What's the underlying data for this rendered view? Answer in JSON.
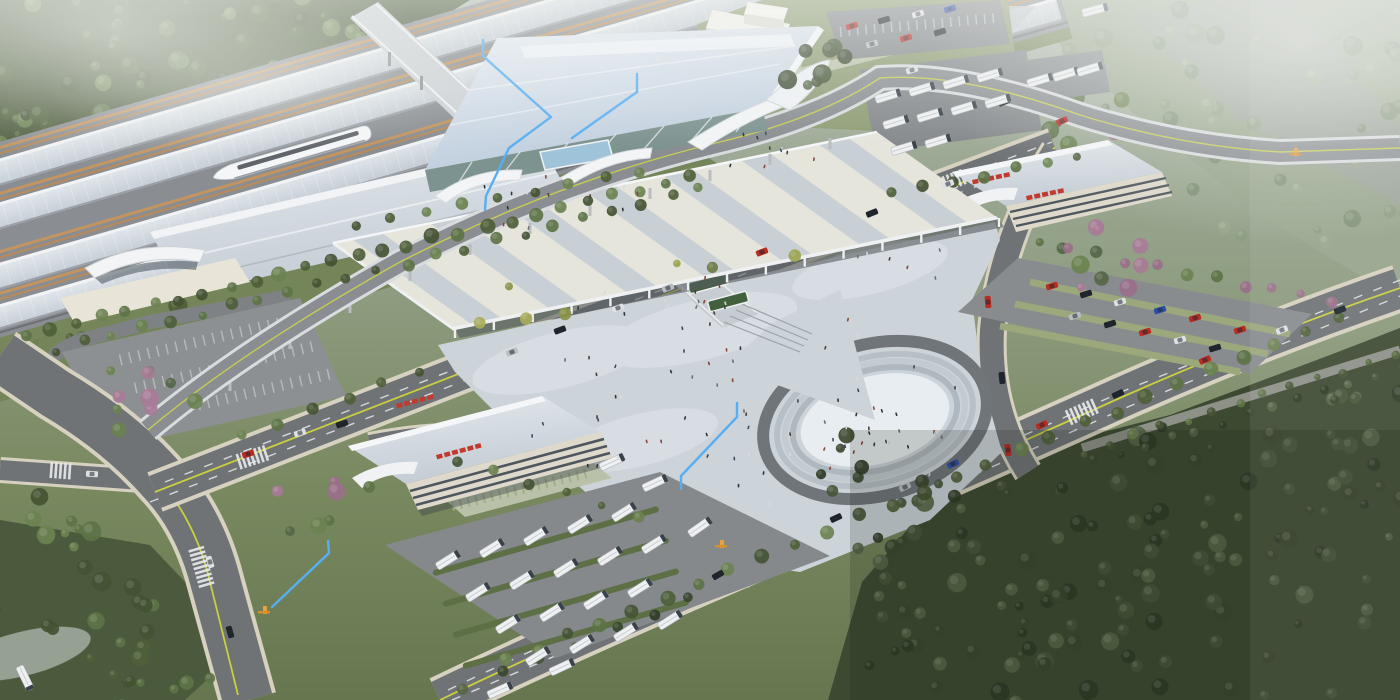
{
  "scene": {
    "kind": "aerial-architectural-rendering",
    "regions": [
      {
        "id": "railway-platforms",
        "label": "railway platforms and tracks with high-speed train"
      },
      {
        "id": "station-hall",
        "label": "main station terminal hall with glass facade"
      },
      {
        "id": "departure-canopy",
        "label": "large striped concourse canopy"
      },
      {
        "id": "central-plaza",
        "label": "pedestrian plaza with oval amphitheater"
      },
      {
        "id": "bus-terminal",
        "label": "bus terminal building and bus yard"
      },
      {
        "id": "parking-garage-east",
        "label": "east parking garage and car lot"
      },
      {
        "id": "roads",
        "label": "boulevards with lane markings and vehicles"
      },
      {
        "id": "forest",
        "label": "surrounding forest and misty terrain"
      }
    ],
    "signage": {
      "note": "illegible red character blocks on building roofs",
      "color": "#c23a2e"
    }
  },
  "palette": {
    "sky_mist": "#aeb8ab",
    "terrain_green": "#7a8a62",
    "forest_dark": "#3c4a30",
    "forest_mid": "#55663f",
    "tree_light": "#7d9258",
    "grass_verge": "#74855a",
    "lawn": "#8e9d74",
    "track_bed": "#8a8e92",
    "track_stripe": "#c3945f",
    "platform_canopy": "#ccd2d8",
    "station_roof": "#cfdcea",
    "glass_facade": "#7d9390",
    "entrance_white": "#f2f4f6",
    "big_canopy_base": "#e6e5dc",
    "big_canopy_stripe": "#c2ccd4",
    "canopy_shadow": "#565c61",
    "plaza_paving": "#ccd4da",
    "oval_inner": "#e8edf1",
    "step_ring": "#b8c0c7",
    "road_asphalt": "#6f7376",
    "road_ramp": "#8a8e92",
    "sidewalk": "#d7d1c0",
    "lane_yellow": "#c9cf3e",
    "lane_white": "#e8eaec",
    "building_facade": "#ded9ca",
    "facade_band": "#4e575e",
    "roof_white": "#eef1f3",
    "sign_red": "#c23a2e",
    "bus_body": "#eef0f2",
    "car_red": "#b92c22",
    "car_blue": "#2c4faa",
    "car_black": "#1e2429",
    "car_white": "#dfe2e4",
    "car_silver": "#b9bec2",
    "annotation_blue": "#58aef2",
    "gate_orange": "#e8a23c",
    "fog_white": "#f2f4f1"
  },
  "annotations": {
    "color": "#58aef2",
    "lines": [
      {
        "id": "callout-roof",
        "points": "483,40 483,56 551,117"
      },
      {
        "id": "callout-facade",
        "points": "637,74 637,92 572,138"
      },
      {
        "id": "callout-entrance",
        "points": "551,117 509,148 486,196 485,210"
      },
      {
        "id": "callout-plaza",
        "points": "737,403 737,417 681,476 681,489"
      },
      {
        "id": "callout-bus-gate",
        "points": "328,541 329,553 272,607"
      }
    ],
    "gate_marker_color": "#e8a23c",
    "gate_count": 3
  }
}
